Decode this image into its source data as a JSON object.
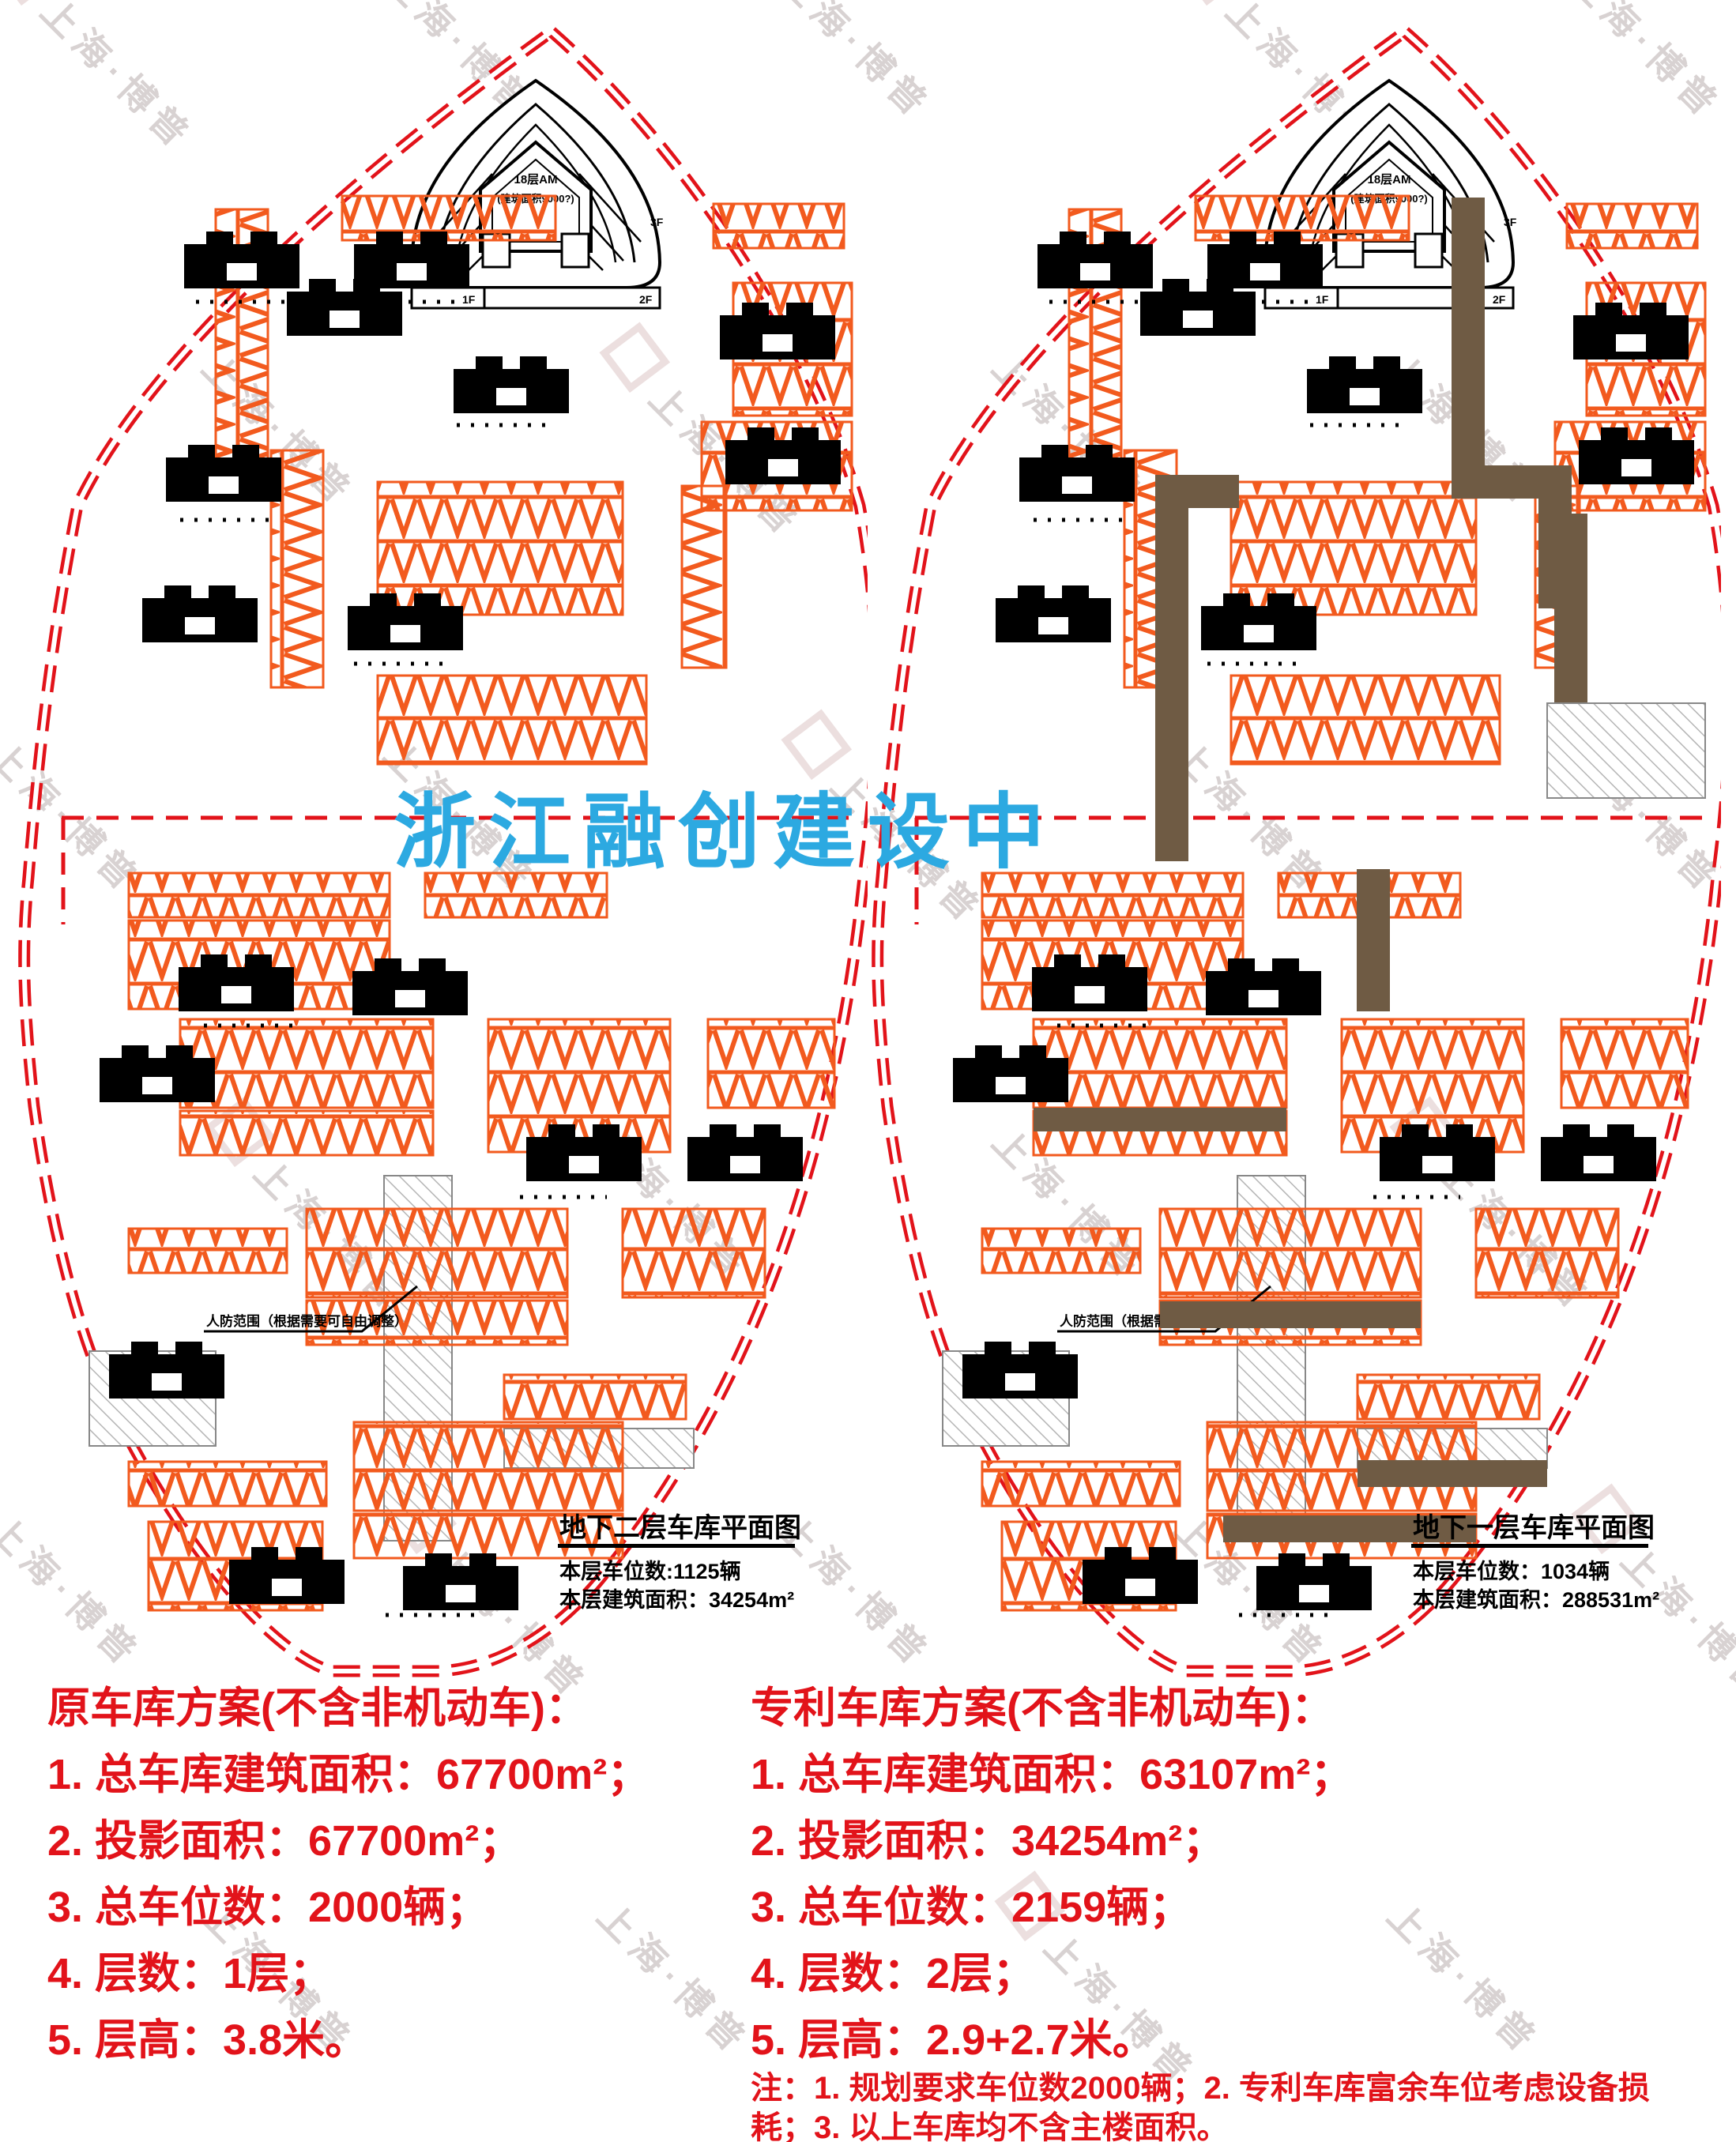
{
  "watermark": {
    "text": "上海·博普"
  },
  "center_overlay": {
    "text": "浙江融创建设中",
    "color": "#2ca9e1"
  },
  "tower": {
    "line1": "18层AM",
    "line2": "(建筑面积9000?)",
    "floor1": "1F",
    "floor2": "2F",
    "floor3": "3F"
  },
  "plans": {
    "left": {
      "title": "地下二层车库平面图",
      "stat1": "本层车位数:1125辆",
      "stat2": "本层建筑面积：34254m²",
      "annotation": "人防范围（根据需要可自由调整）"
    },
    "right": {
      "title": "地下一层车库平面图",
      "stat1": "本层车位数：1034辆",
      "stat2": "本层建筑面积：288531m²",
      "annotation": "人防范围（根据需要可自由调整）"
    }
  },
  "schemes": {
    "original": {
      "heading": "原车库方案(不含非机动车)：",
      "items": [
        "1. 总车库建筑面积：67700m²；",
        "2. 投影面积：67700m²；",
        "3. 总车位数：2000辆；",
        "4. 层数：1层；",
        "5. 层高：3.8米。"
      ]
    },
    "patent": {
      "heading": "专利车库方案(不含非机动车)：",
      "items": [
        "1. 总车库建筑面积：63107m²；",
        "2. 投影面积：34254m²；",
        "3. 总车位数：2159辆；",
        "4. 层数：2层；",
        "5. 层高：2.9+2.7米。"
      ]
    },
    "note_lines": [
      "注：1. 规划要求车位数2000辆；2. 专利车库富余车位考虑设备损",
      "耗；3. 以上车库均不含主楼面积。"
    ]
  },
  "colors": {
    "red_text": "#e2131a",
    "boundary_red": "#e2131a",
    "stall_orange": "#f25a1e",
    "corridor_brown": "#6f5b44",
    "overlay_blue": "#2ca9e1",
    "watermark_gray": "#d8d2d2"
  }
}
